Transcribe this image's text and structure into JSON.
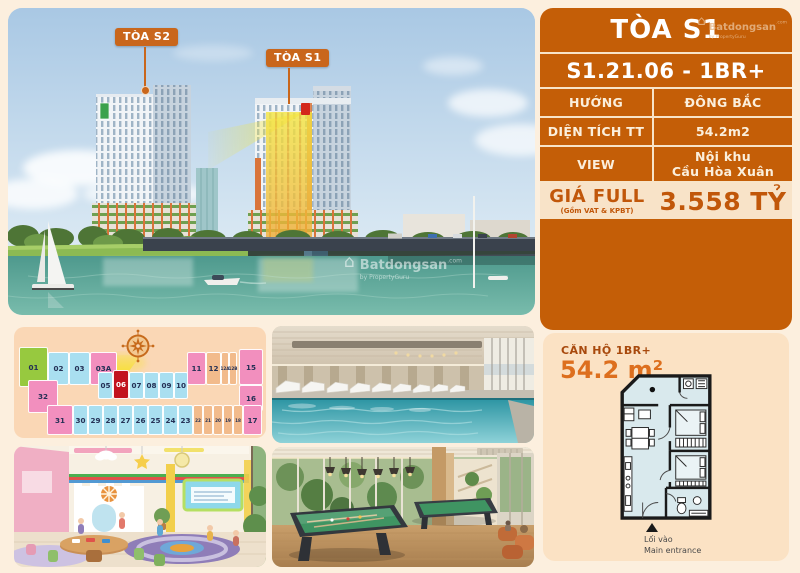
{
  "brand": {
    "name": "Batdongsan",
    "suffix": ".com",
    "byline": "by PropertyGuru",
    "house_glyph": "⌂"
  },
  "colors": {
    "accent_orange": "#C45E07",
    "cream": "#F8E3C8",
    "page_bg": "#FCEFDE",
    "highlight_yellow": "#F4E63F",
    "selected_red": "#C2121E"
  },
  "photo": {
    "tower_s2_label": "TÒA S2",
    "tower_s1_label": "TÒA S1",
    "watermark_name": "Batdongsan",
    "watermark_byline": "by PropertyGuru"
  },
  "panel": {
    "title": "TÒA S1",
    "unit_code": "S1.21.06 - 1BR+",
    "rows": [
      {
        "label": "HƯỚNG",
        "value": "ĐÔNG BẮC"
      },
      {
        "label": "DIỆN TÍCH TT",
        "value": "54.2m2"
      },
      {
        "label": "VIEW",
        "value": "Nội khu\nCầu Hòa Xuân"
      }
    ],
    "price_label": "GIÁ FULL",
    "price_sub": "(Gồm VAT & KPBT)",
    "price_value": "3.558 TỶ"
  },
  "keyplan": {
    "highlight_unit": "06",
    "cells": [
      {
        "label": "01",
        "color": "green",
        "x": 5,
        "y": 20,
        "w": 29,
        "h": 40
      },
      {
        "label": "02",
        "color": "blue",
        "x": 34,
        "y": 25,
        "w": 21,
        "h": 33
      },
      {
        "label": "03",
        "color": "blue",
        "x": 55,
        "y": 25,
        "w": 21,
        "h": 33
      },
      {
        "label": "03A",
        "color": "pink",
        "x": 76,
        "y": 25,
        "w": 27,
        "h": 33
      },
      {
        "label": "11",
        "color": "pink",
        "x": 173,
        "y": 25,
        "w": 19,
        "h": 33
      },
      {
        "label": "12",
        "color": "orange",
        "x": 192,
        "y": 25,
        "w": 15,
        "h": 33
      },
      {
        "label": "12A",
        "color": "orange",
        "x": 207,
        "y": 25,
        "w": 8,
        "h": 33
      },
      {
        "label": "12B",
        "color": "orange",
        "x": 215,
        "y": 25,
        "w": 8,
        "h": 33
      },
      {
        "label": "15",
        "color": "pink",
        "x": 225,
        "y": 22,
        "w": 24,
        "h": 36
      },
      {
        "label": "32",
        "color": "pink",
        "x": 14,
        "y": 53,
        "w": 30,
        "h": 33
      },
      {
        "label": "05",
        "color": "blue",
        "x": 84,
        "y": 45,
        "w": 15,
        "h": 27
      },
      {
        "label": "06",
        "color": "red",
        "x": 99,
        "y": 43,
        "w": 16,
        "h": 29
      },
      {
        "label": "07",
        "color": "blue",
        "x": 115,
        "y": 45,
        "w": 15,
        "h": 27
      },
      {
        "label": "08",
        "color": "blue",
        "x": 130,
        "y": 45,
        "w": 15,
        "h": 27
      },
      {
        "label": "09",
        "color": "blue",
        "x": 145,
        "y": 45,
        "w": 15,
        "h": 27
      },
      {
        "label": "10",
        "color": "blue",
        "x": 160,
        "y": 45,
        "w": 14,
        "h": 27
      },
      {
        "label": "16",
        "color": "pink",
        "x": 225,
        "y": 58,
        "w": 24,
        "h": 26
      },
      {
        "label": "31",
        "color": "pink",
        "x": 33,
        "y": 78,
        "w": 26,
        "h": 30
      },
      {
        "label": "30",
        "color": "blue",
        "x": 59,
        "y": 78,
        "w": 15,
        "h": 30
      },
      {
        "label": "29",
        "color": "blue",
        "x": 74,
        "y": 78,
        "w": 15,
        "h": 30
      },
      {
        "label": "28",
        "color": "blue",
        "x": 89,
        "y": 78,
        "w": 15,
        "h": 30
      },
      {
        "label": "27",
        "color": "blue",
        "x": 104,
        "y": 78,
        "w": 15,
        "h": 30
      },
      {
        "label": "26",
        "color": "blue",
        "x": 119,
        "y": 78,
        "w": 15,
        "h": 30
      },
      {
        "label": "25",
        "color": "blue",
        "x": 134,
        "y": 78,
        "w": 15,
        "h": 30
      },
      {
        "label": "24",
        "color": "blue",
        "x": 149,
        "y": 78,
        "w": 15,
        "h": 30
      },
      {
        "label": "23",
        "color": "blue",
        "x": 164,
        "y": 78,
        "w": 15,
        "h": 30
      },
      {
        "label": "22",
        "color": "orange",
        "x": 179,
        "y": 78,
        "w": 10,
        "h": 30
      },
      {
        "label": "21",
        "color": "orange",
        "x": 189,
        "y": 78,
        "w": 10,
        "h": 30
      },
      {
        "label": "20",
        "color": "orange",
        "x": 199,
        "y": 78,
        "w": 10,
        "h": 30
      },
      {
        "label": "19",
        "color": "orange",
        "x": 209,
        "y": 78,
        "w": 10,
        "h": 30
      },
      {
        "label": "18",
        "color": "orange",
        "x": 219,
        "y": 78,
        "w": 10,
        "h": 30
      },
      {
        "label": "17",
        "color": "pink",
        "x": 229,
        "y": 78,
        "w": 19,
        "h": 30
      }
    ]
  },
  "plan_card": {
    "title": "CĂN HỘ 1BR+",
    "area": "54.2 m²",
    "entrance_vi": "Lối vào",
    "entrance_en": "Main entrance"
  }
}
